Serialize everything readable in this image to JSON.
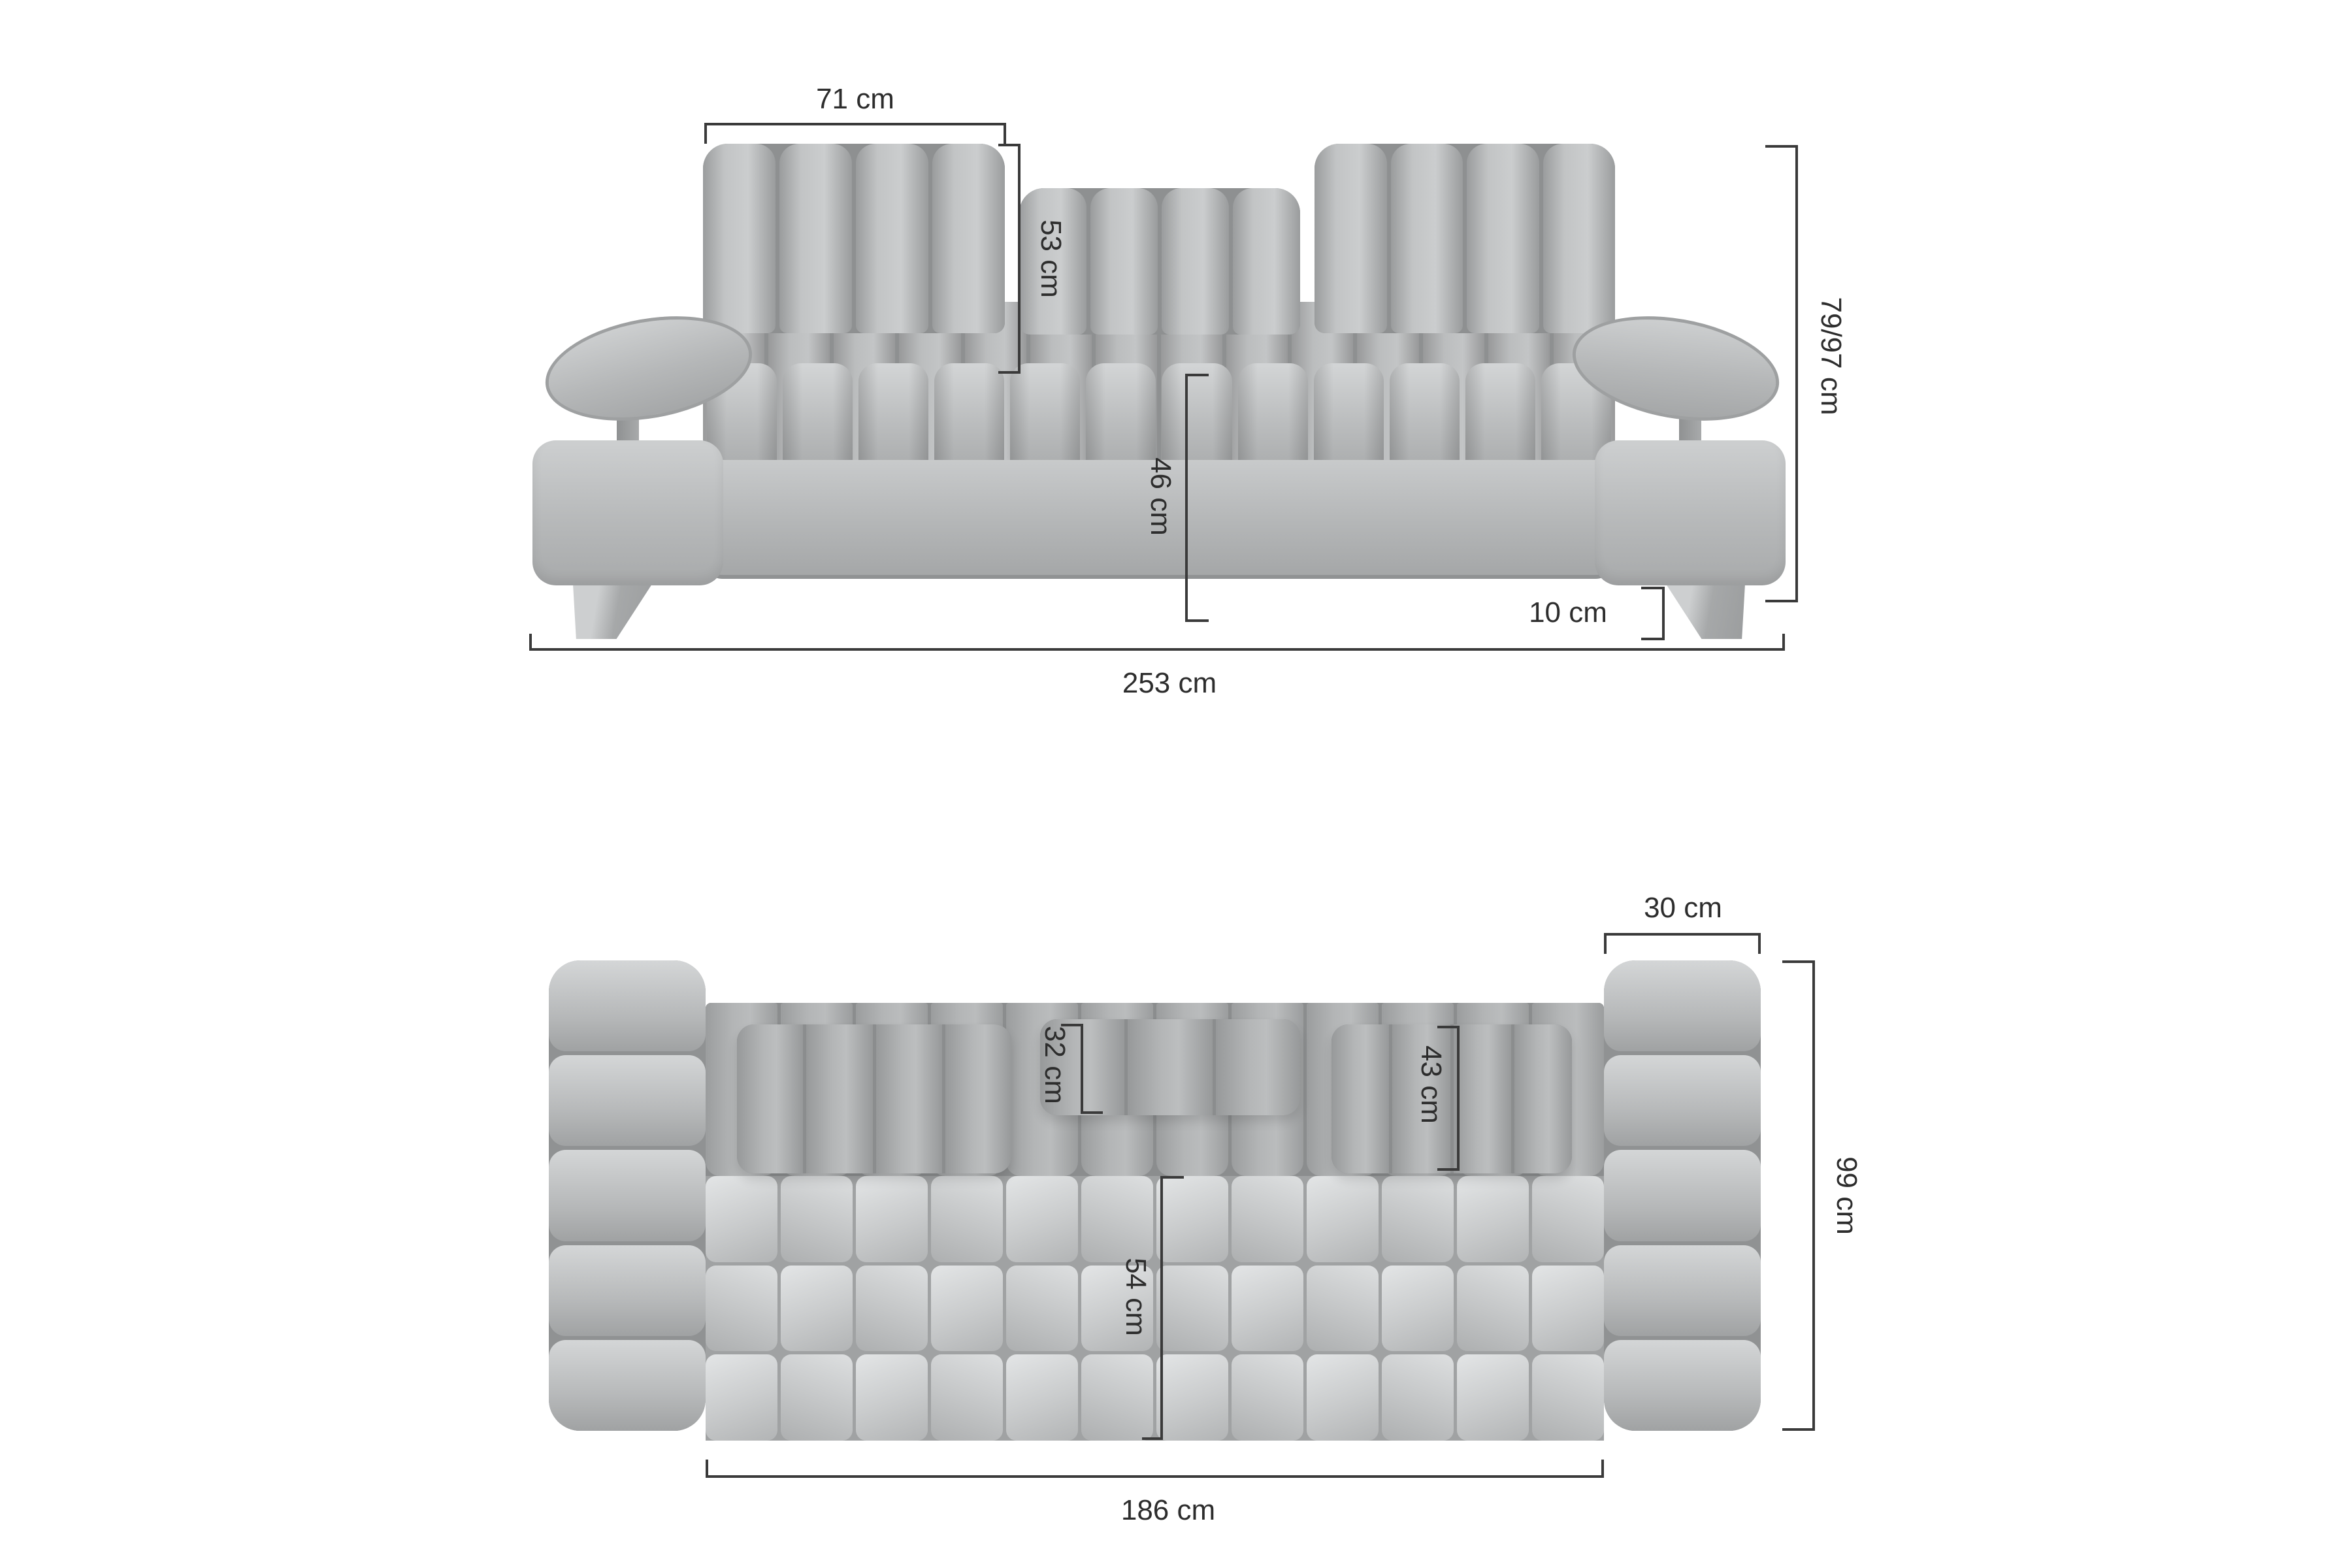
{
  "front": {
    "dims": {
      "headrest_width": "71 cm",
      "headrest_height": "53 cm",
      "overall_height": "79/97 cm",
      "seat_height": "46 cm",
      "leg_height": "10 cm",
      "overall_width": "253 cm"
    }
  },
  "top": {
    "dims": {
      "armrest_width": "30 cm",
      "overall_depth": "99 cm",
      "headrest_depth": "32 cm",
      "backrest_depth": "43 cm",
      "seat_depth": "54 cm",
      "seat_width": "186 cm"
    }
  },
  "colors": {
    "background": "#ffffff",
    "upholstery": "#b8babb",
    "upholstery_shadow": "#9a9c9d",
    "upholstery_highlight": "#d4d6d7",
    "dimension_lines": "#3a3a3a",
    "text": "#2d2d2d"
  }
}
